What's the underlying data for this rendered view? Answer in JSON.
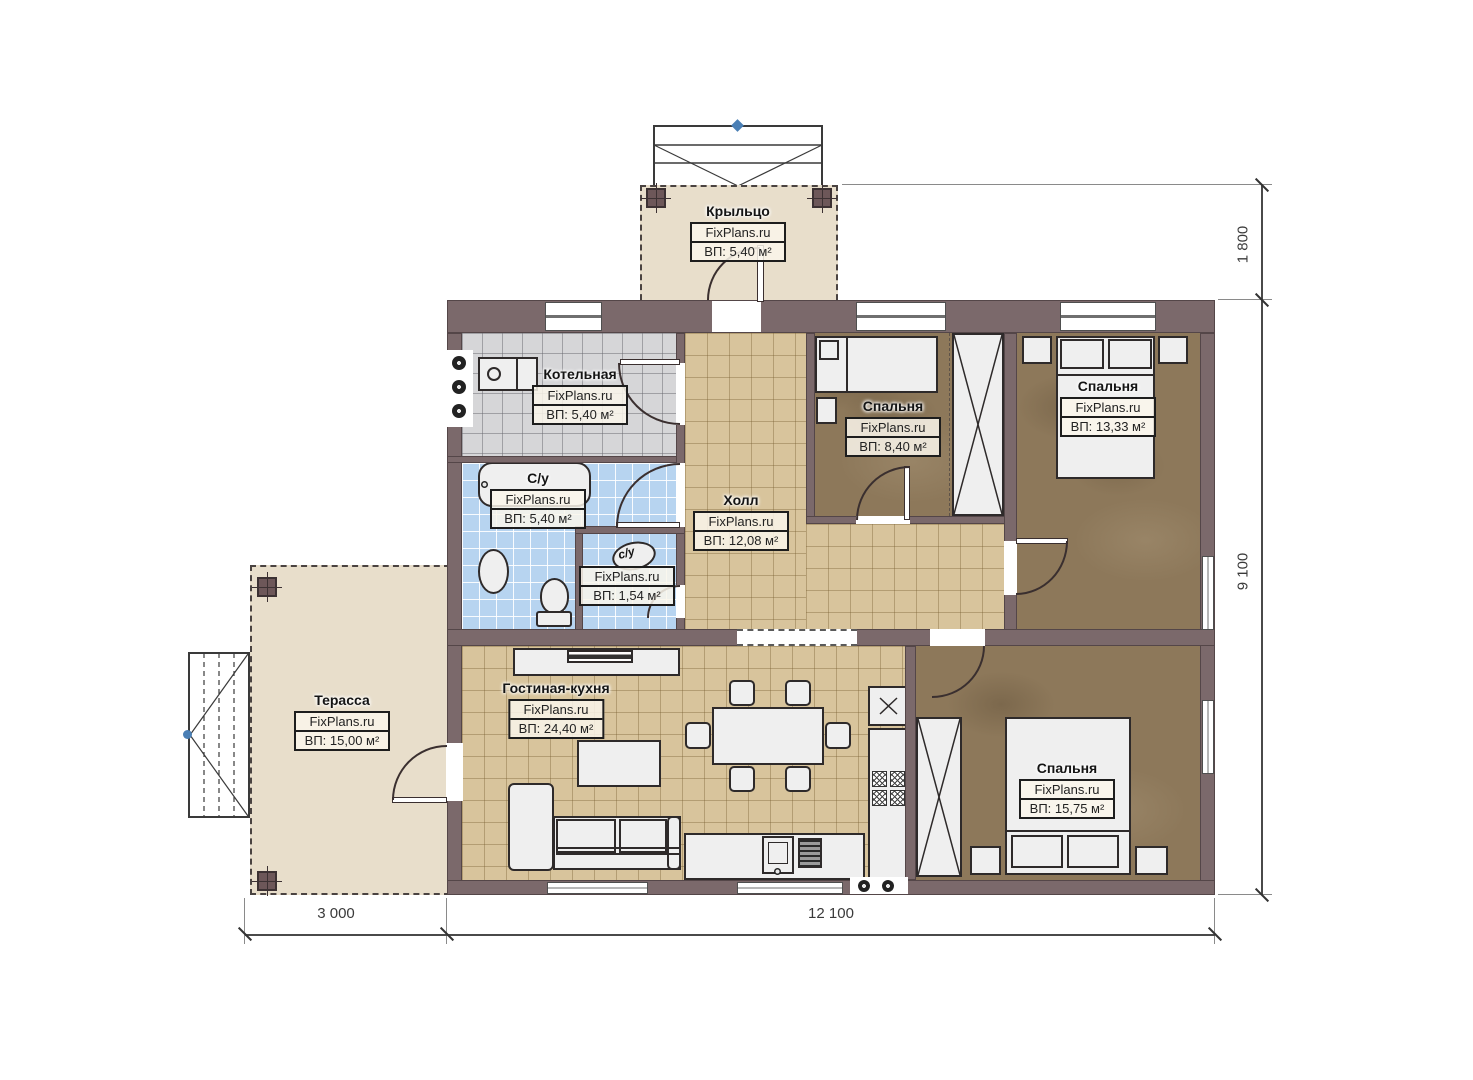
{
  "watermark": "FixPlans.ru",
  "rooms": {
    "porch": {
      "name": "Крыльцо",
      "area": "ВП: 5,40 м²"
    },
    "boiler": {
      "name": "Котельная",
      "area": "ВП: 5,40 м²"
    },
    "bathroom": {
      "name": "С/у",
      "area": "ВП: 5,40 м²"
    },
    "wc": {
      "name": "с/у",
      "area": "ВП: 1,54 м²"
    },
    "hall": {
      "name": "Холл",
      "area": "ВП: 12,08 м²"
    },
    "bedroom_small": {
      "name": "Спальня",
      "area": "ВП: 8,40 м²"
    },
    "bedroom_top": {
      "name": "Спальня",
      "area": "ВП: 13,33 м²"
    },
    "bedroom_bottom": {
      "name": "Спальня",
      "area": "ВП: 15,75 м²"
    },
    "living_kitchen": {
      "name": "Гостиная-кухня",
      "area": "ВП: 24,40 м²"
    },
    "terrace": {
      "name": "Терасса",
      "area": "ВП: 15,00 м²"
    }
  },
  "dimensions": {
    "porch_depth": "1 800",
    "house_depth": "9 100",
    "terrace_width": "3 000",
    "house_width": "12 100"
  },
  "colors": {
    "wall": "#7b696b",
    "tile_tan": "#d8c49c",
    "tile_gray": "#d6d6d8",
    "tile_blue": "#b7d4f0",
    "wood_floor": "#8d785a",
    "deck": "#e8decb",
    "line_dark": "#2e2a2a",
    "accent_blue": "#4a7fb5"
  }
}
